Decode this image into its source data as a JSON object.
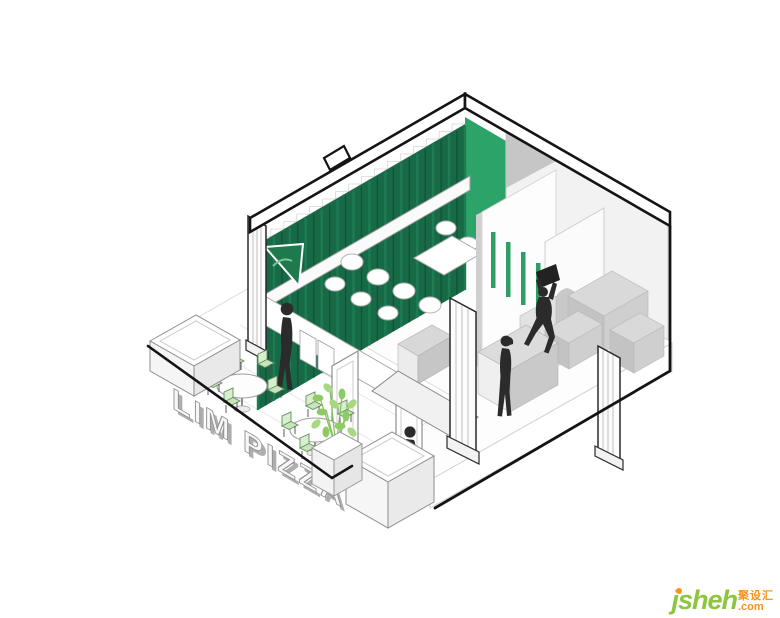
{
  "scene": {
    "kind": "axonometric cutaway architectural illustration",
    "subject": "LIM PIZZA pizzeria interior with street terrace",
    "background_color": "#ffffff",
    "signage": {
      "terrace_letters_line1": "LIM",
      "terrace_letters_line2": "PIZZA",
      "full_text": "LIM PIZZA"
    },
    "palette": {
      "outline_black": "#141414",
      "curtain_dark_green": "#186a47",
      "curtain_pleat_shadow": "#115238",
      "curtain_pleat_light": "#1d7c52",
      "curtain_bright_green": "#2ca368",
      "facade_sign_green": "#1e7a4d",
      "accent_strip_green": "#2f9e63",
      "chair_green": "#cde8c3",
      "plant_green": "#a8d87f",
      "wall_white": "#ffffff",
      "shade_gray": "#c6c6c6",
      "figure_black": "#2b2b2b"
    },
    "elements": {
      "figures": [
        "person walking at entrance",
        "man walking a dog",
        "woman standing at counter",
        "person lifting a box onto ledge"
      ],
      "furniture": [
        "two round terrace tables with green folding chairs",
        "white lounge chairs along green curtain wall",
        "three white planter boxes",
        "potted green plant"
      ],
      "architecture": [
        "pleated green curtain wall with sawtooth top",
        "bright green corner wall",
        "white cross beam",
        "partition wall with four hanging green strips",
        "arched niche wall",
        "fluted white pilasters",
        "open pivot doors and tilted awning glass",
        "street terrace slab"
      ]
    }
  },
  "watermark": {
    "brand": "jsheh",
    "tld": ".com",
    "cjk_label": "聚设汇",
    "brand_color": "#8cc63e",
    "accent_color": "#f7941d"
  }
}
